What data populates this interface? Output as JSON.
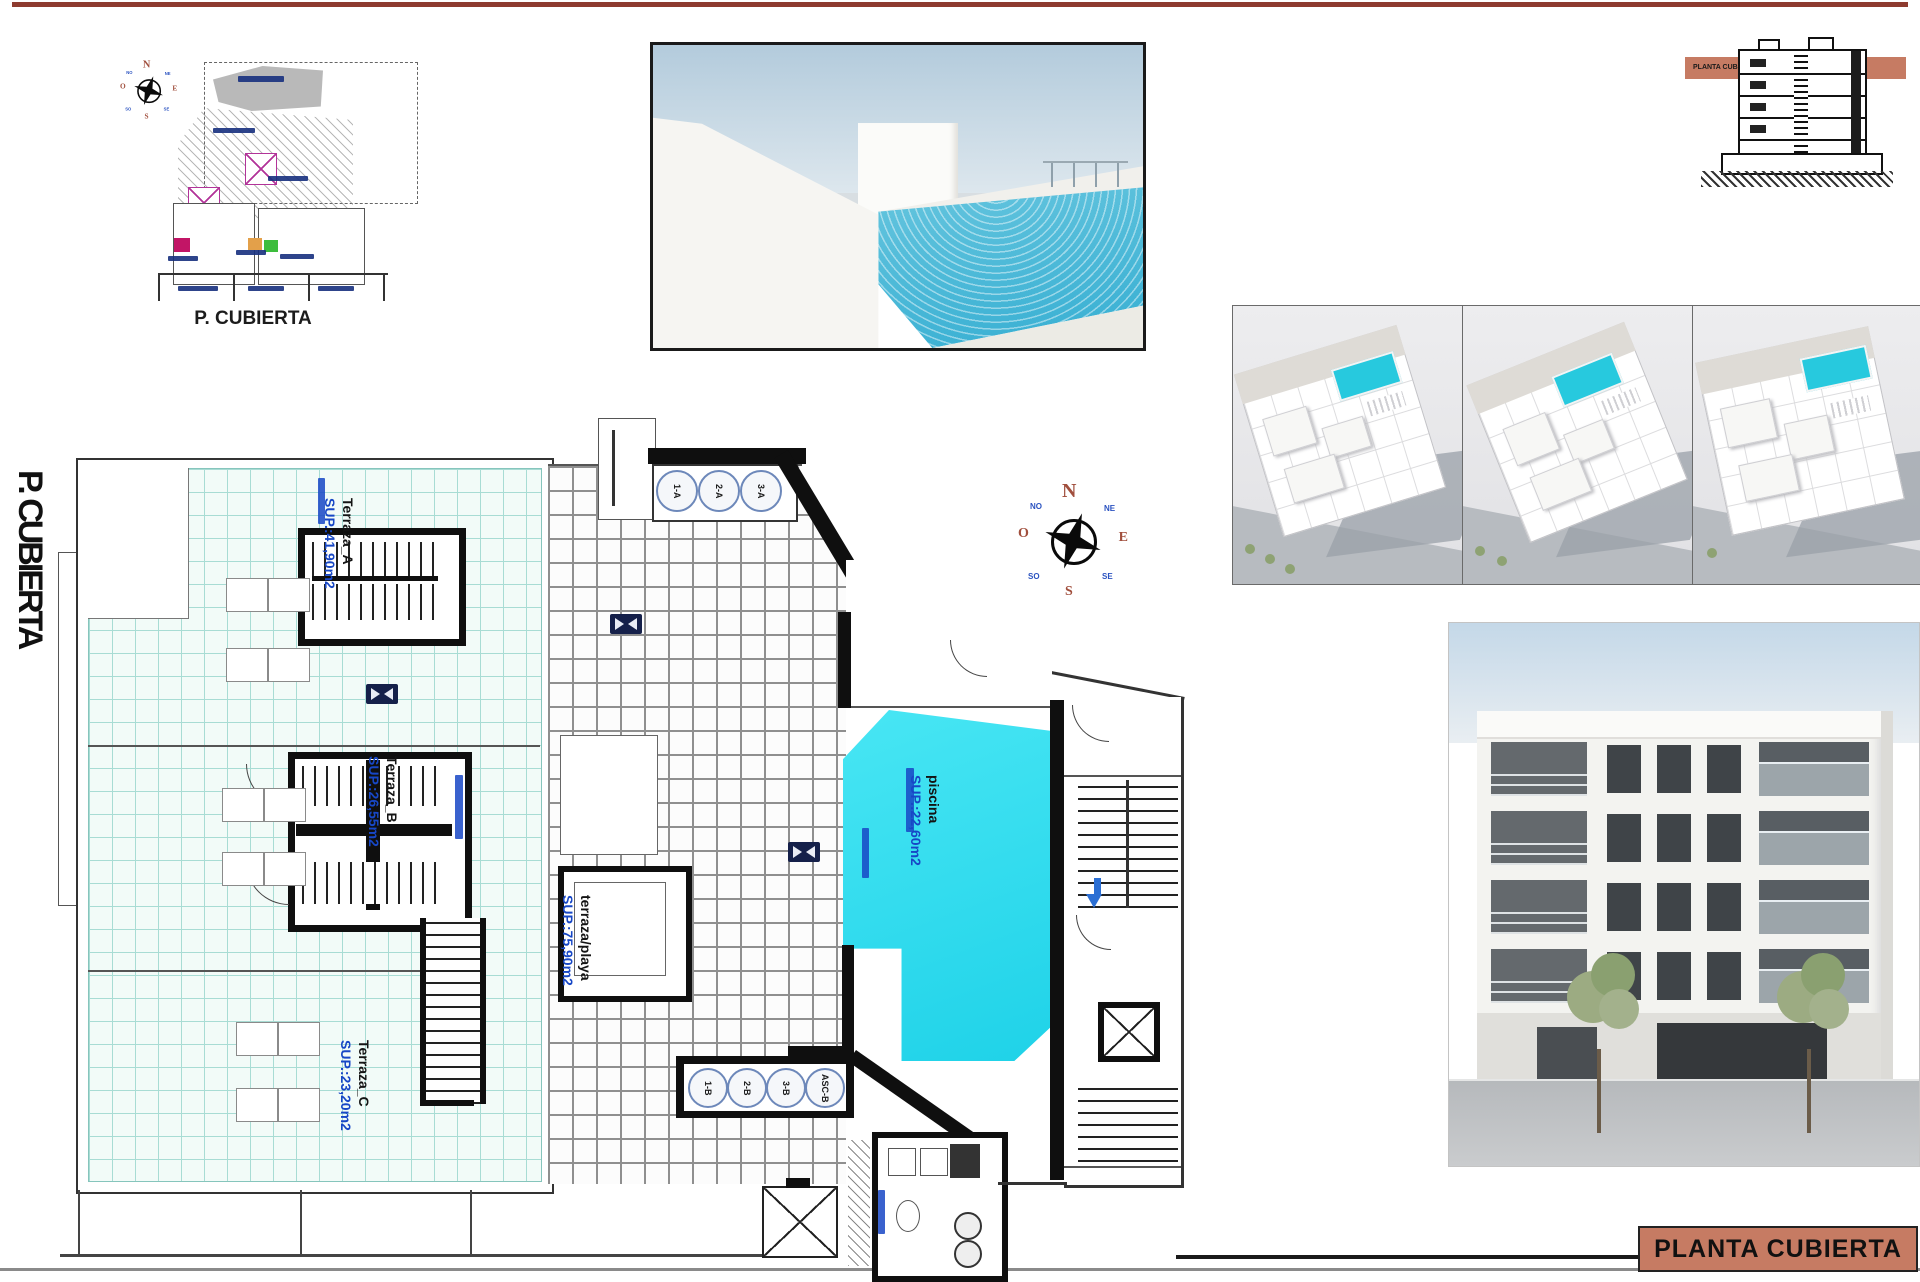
{
  "sheet": {
    "side_title": "P. CUBIERTA",
    "title_block": "PLANTA CUBIERTA"
  },
  "site_plan": {
    "caption": "P. CUBIERTA"
  },
  "section_drawing": {
    "band_label": "PLANTA CUBIERTA"
  },
  "floor_plan": {
    "terraces": [
      {
        "name": "Terraza_A",
        "area": "SUP.:41,90m2"
      },
      {
        "name": "Terraza_B",
        "area": "SUP.:26,55m2"
      },
      {
        "name": "Terraza_C",
        "area": "SUP.:23,20m2"
      }
    ],
    "beach_terrace": {
      "name": "terraza/playa",
      "area": "SUP.:75,90m2"
    },
    "pool": {
      "name": "piscina",
      "area": "SUP.:22,60m2"
    },
    "skylights_top": [
      "1-A",
      "2-A",
      "3-A"
    ],
    "skylights_bottom": [
      "1-B",
      "2-B",
      "3-B",
      "ASC-B"
    ],
    "compass": {
      "n": "N",
      "s": "S",
      "e": "E",
      "w": "O",
      "ne": "NE",
      "nw": "NO",
      "se": "SE",
      "sw": "SO"
    }
  },
  "colors": {
    "top_rule": "#8E3B2F",
    "accent_salmon": "#C67B63",
    "pool_cyan": "#35DFF0",
    "terrace_tile_line": "#A8DCD4",
    "label_blue": "#1747C6"
  }
}
